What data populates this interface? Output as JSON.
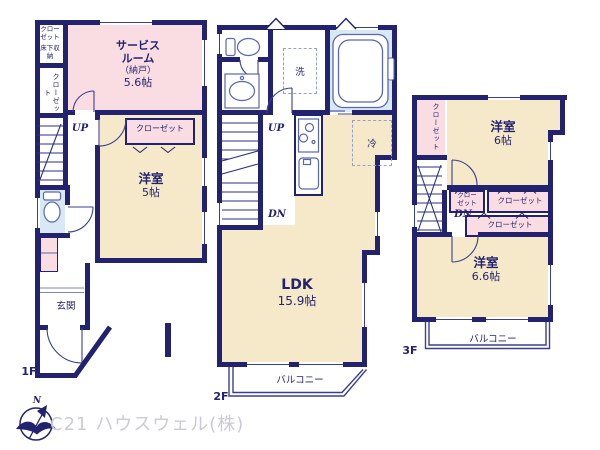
{
  "watermark": "C21 ハウスウェル(株)",
  "compass_north": "N",
  "f1": {
    "floor_label": "1F",
    "closet_top": "クローゼット",
    "underfloor_storage": "床下収納",
    "closet_left": "クローゼット",
    "up": "UP",
    "service_room_name": "サービスルーム",
    "service_room_sub": "（納戸）",
    "service_room_size": "5.6帖",
    "closet_room": "クローゼット",
    "western_room_name": "洋室",
    "western_room_size": "5帖",
    "entrance": "玄関"
  },
  "f2": {
    "floor_label": "2F",
    "wash": "洗",
    "fridge": "冷",
    "up": "UP",
    "down": "DN",
    "ldk_name": "LDK",
    "ldk_size": "15.9帖",
    "balcony": "バルコニー"
  },
  "f3": {
    "floor_label": "3F",
    "closet_left": "クローゼット",
    "room6_name": "洋室",
    "room6_size": "6帖",
    "down": "DN",
    "closet_a": "クローゼット",
    "closet_b": "クローゼット",
    "closet_c": "クローゼット",
    "room66_name": "洋室",
    "room66_size": "6.6帖",
    "balcony": "バルコニー"
  },
  "colors": {
    "wall": "#23226e",
    "room_yellow": "#f5e9c9",
    "room_pink": "#f9dde3",
    "room_blue": "#d9e8f5",
    "fixture_line": "#5a67ad",
    "watermark": "#cbcbd6"
  }
}
